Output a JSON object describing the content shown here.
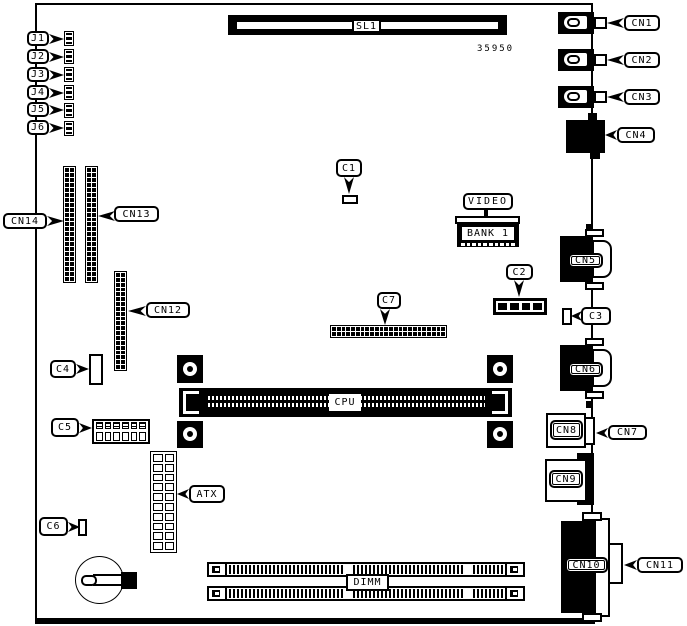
{
  "figure": {
    "part_number": "35950"
  },
  "callouts": {
    "j1": "J1",
    "j2": "J2",
    "j3": "J3",
    "j4": "J4",
    "j5": "J5",
    "j6": "J6",
    "cn1": "CN1",
    "cn2": "CN2",
    "cn3": "CN3",
    "cn4": "CN4",
    "cn7": "CN7",
    "cn11": "CN11",
    "cn12": "CN12",
    "cn13": "CN13",
    "cn14": "CN14",
    "c1": "C1",
    "c2": "C2",
    "c3": "C3",
    "c4": "C4",
    "c5": "C5",
    "c6": "C6",
    "c7": "C7",
    "atx": "ATX",
    "video": "VIDEO"
  },
  "component_labels": {
    "sl1": "SL1",
    "bank1": "BANK 1",
    "cpu": "CPU",
    "dimm": "DIMM",
    "cn5": "CN5",
    "cn6": "CN6",
    "cn8": "CN8",
    "cn9": "CN9",
    "cn10": "CN10"
  },
  "graphics": {
    "jumper": {
      "cols": 1,
      "rows": 3,
      "gap": 2,
      "style": "fill"
    },
    "header_23x2": {
      "cols": 2,
      "rows": 23,
      "gap": 1,
      "style": "fill"
    },
    "header_20x2": {
      "cols": 2,
      "rows": 20,
      "gap": 1,
      "style": "fill"
    },
    "c7_pins": {
      "cols": 24,
      "rows": 2,
      "gap": 1,
      "style": "fill"
    },
    "atx_pins": {
      "cols": 2,
      "rows": 10,
      "gap": 2,
      "style": "outline"
    },
    "c2_pins": {
      "cols": 4,
      "rows": 1,
      "gap": 3,
      "style": "fill"
    },
    "bank1_pins": {
      "cols": 10,
      "rows": 1,
      "gap": 2,
      "style": "white"
    },
    "c5_top": {
      "cols": 6,
      "rows": 1,
      "gap": 2,
      "style": "hatch"
    },
    "c5_bottom": {
      "cols": 6,
      "rows": 1,
      "gap": 2,
      "style": "outline"
    }
  }
}
